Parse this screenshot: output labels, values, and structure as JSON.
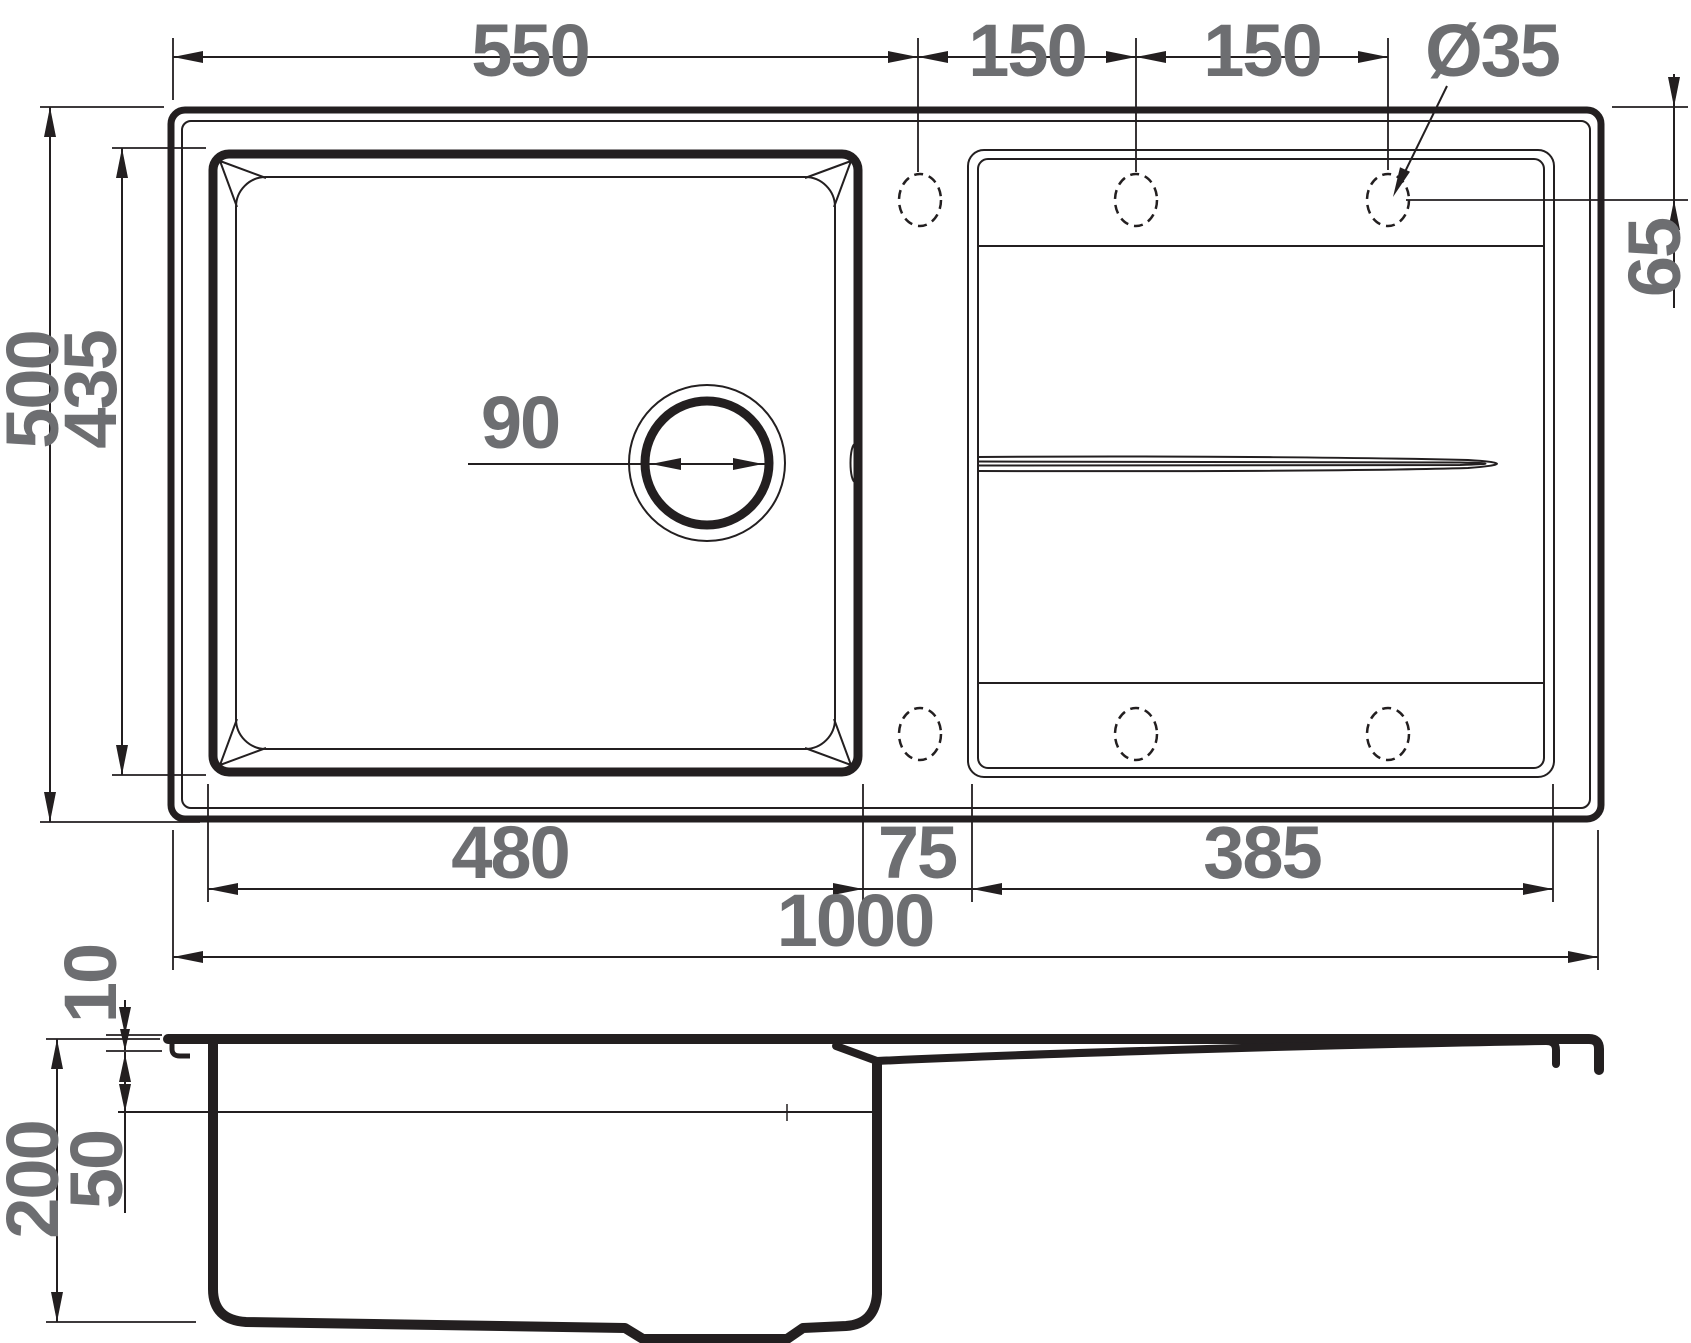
{
  "drawing": {
    "kind": "technical-dimension-drawing",
    "subject": "kitchen sink with single bowl and drainboard",
    "units": "mm",
    "views": {
      "primary": "top view",
      "secondary": "side section view"
    }
  },
  "dimensions": {
    "edge_to_first_hole": "550",
    "hole_spacing_a": "150",
    "hole_spacing_b": "150",
    "tap_hole_diameter": "Ø35",
    "hole_center_from_top_edge": "65",
    "overall_depth": "500",
    "bowl_outer_height": "435",
    "drain_diameter": "90",
    "bowl_width": "480",
    "bowl_to_drainboard_gap": "75",
    "drainboard_width": "385",
    "overall_width": "1000",
    "rim_height": "10",
    "total_height_side": "200",
    "rim_to_overflow_level": "50"
  },
  "features": {
    "tap_holes_count": 6,
    "tap_hole_style": "dashed (knock-out)",
    "has_overflow_slot": true,
    "has_drainboard_groove": true
  },
  "colors": {
    "line": "#231f20",
    "dim_text": "#6d6e71",
    "background": "#ffffff"
  }
}
